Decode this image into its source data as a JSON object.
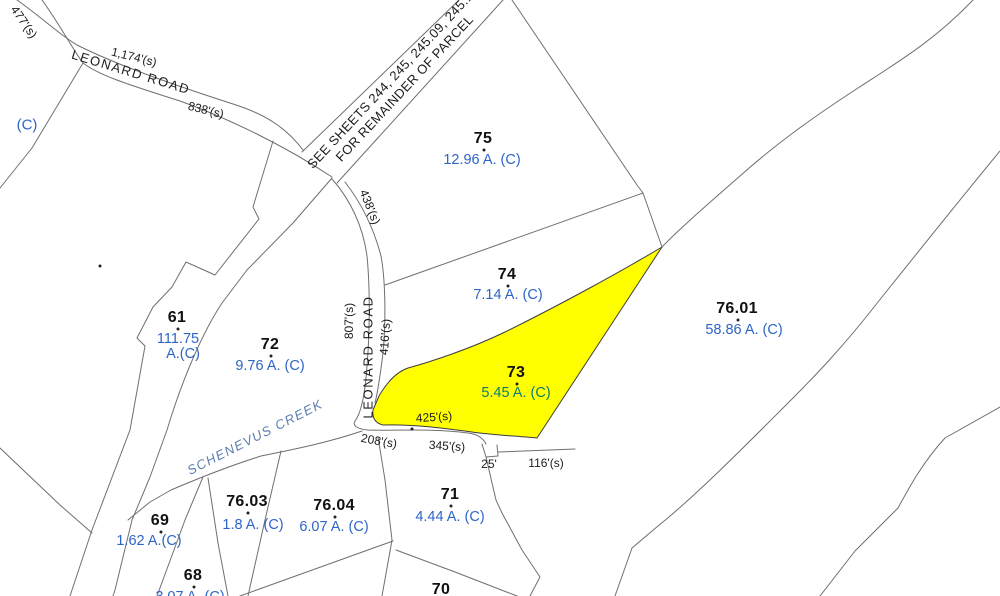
{
  "colors": {
    "highlight_fill": "#ffff00",
    "boundary_line": "#6f6f6f",
    "highlight_outline": "#3d3d3d",
    "parcel_number": "#111111",
    "acreage_text": "#2e64c8",
    "highlighted_acreage_text": "#0c7d68",
    "creek_text": "#5b7db1"
  },
  "note": {
    "lines": [
      "SEE SHEETS 244, 245, 245.09, 245.10",
      "FOR REMAINDER OF PARCEL"
    ],
    "x": 399,
    "y": 83,
    "rot": -47
  },
  "roads": [
    {
      "label": "LEONARD ROAD",
      "x": 131,
      "y": 72,
      "rot": 17
    },
    {
      "label": "LEONARD ROAD",
      "x": 368,
      "y": 357,
      "rot": -90
    }
  ],
  "creek": {
    "label": "SCHENEVUS CREEK",
    "x": 255,
    "y": 437,
    "rot": -27
  },
  "corner_label": {
    "text": "(C)",
    "x": 27,
    "y": 125
  },
  "parcels": [
    {
      "number": "75",
      "acreage": "12.96 A. (C)",
      "x": 483,
      "y": 139,
      "ax": 482,
      "ay": 160
    },
    {
      "number": "74",
      "acreage": "7.14 A. (C)",
      "x": 507,
      "y": 275,
      "ax": 508,
      "ay": 295
    },
    {
      "number": "73",
      "acreage": "5.45 A. (C)",
      "x": 516,
      "y": 373,
      "ax": 516,
      "ay": 393,
      "highlighted": true
    },
    {
      "number": "76.01",
      "acreage": "58.86 A. (C)",
      "x": 737,
      "y": 309,
      "ax": 744,
      "ay": 330
    },
    {
      "number": "61",
      "acreage": "111.75",
      "acreage2": "A.(C)",
      "x": 177,
      "y": 318,
      "ax": 178,
      "ay": 339
    },
    {
      "number": "72",
      "acreage": "9.76 A. (C)",
      "x": 270,
      "y": 345,
      "ax": 270,
      "ay": 366
    },
    {
      "number": "71",
      "acreage": "4.44 A. (C)",
      "x": 450,
      "y": 495,
      "ax": 450,
      "ay": 517
    },
    {
      "number": "76.03",
      "acreage": "1.8 A. (C)",
      "x": 247,
      "y": 502,
      "ax": 253,
      "ay": 525
    },
    {
      "number": "76.04",
      "acreage": "6.07 A. (C)",
      "x": 334,
      "y": 506,
      "ax": 334,
      "ay": 527
    },
    {
      "number": "69",
      "acreage": "1.62 A.(C)",
      "x": 160,
      "y": 521,
      "ax": 149,
      "ay": 541
    },
    {
      "number": "68",
      "acreage": "3.07 A. (C)",
      "x": 193,
      "y": 576,
      "ax": 190,
      "ay": 597
    },
    {
      "number": "70",
      "acreage": "",
      "x": 441,
      "y": 590,
      "ax": 441,
      "ay": 610
    }
  ],
  "distance_labels": [
    {
      "text": "477'(s)",
      "x": 24,
      "y": 22,
      "rot": 55
    },
    {
      "text": "1,174'(s)",
      "x": 134,
      "y": 57,
      "rot": 14
    },
    {
      "text": "838'(s)",
      "x": 206,
      "y": 110,
      "rot": 14
    },
    {
      "text": "438'(s)",
      "x": 370,
      "y": 207,
      "rot": 68
    },
    {
      "text": "807'(s)",
      "x": 349,
      "y": 321,
      "rot": -90
    },
    {
      "text": "416'(s)",
      "x": 385,
      "y": 337,
      "rot": -86
    },
    {
      "text": "425'(s)",
      "x": 434,
      "y": 417,
      "rot": -4
    },
    {
      "text": "208'(s)",
      "x": 379,
      "y": 441,
      "rot": 10
    },
    {
      "text": "345'(s)",
      "x": 447,
      "y": 446,
      "rot": 4
    },
    {
      "text": "25'",
      "x": 489,
      "y": 464,
      "rot": 0
    },
    {
      "text": "116'(s)",
      "x": 546,
      "y": 463,
      "rot": 0
    }
  ],
  "point_markers": [
    {
      "x": 100,
      "y": 266
    },
    {
      "x": 412,
      "y": 429
    }
  ]
}
